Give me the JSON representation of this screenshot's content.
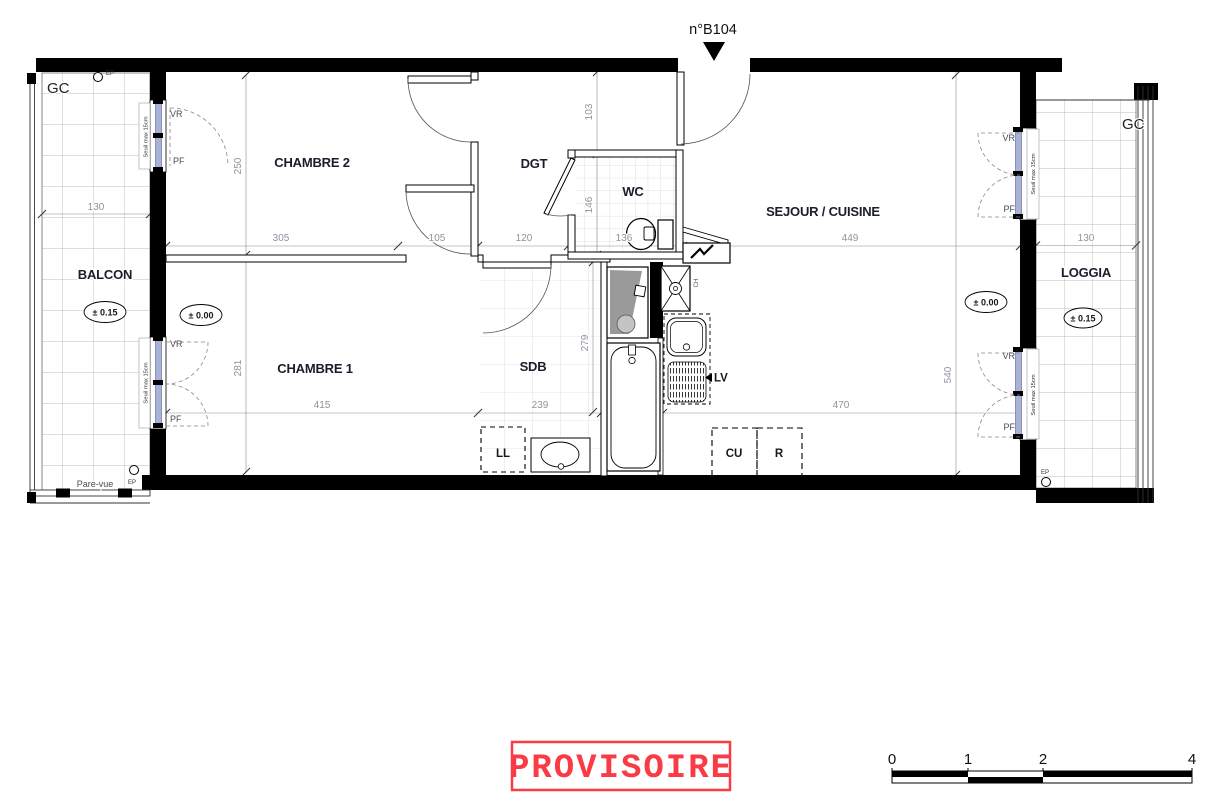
{
  "title": {
    "unit": "n°B104"
  },
  "rooms": {
    "chambre2": "CHAMBRE 2",
    "chambre1": "CHAMBRE 1",
    "dgt": "DGT",
    "wc": "WC",
    "sejour": "SEJOUR / CUISINE",
    "sdb": "SDB",
    "balcon": "BALCON",
    "loggia": "LOGGIA"
  },
  "levels": {
    "exterior": "± 0.15",
    "interior": "± 0.00"
  },
  "annotations": {
    "gc": "GC",
    "ep": "EP",
    "vr": "VR",
    "pf": "PF",
    "seuil": "Seuil max 15cm",
    "pare_vue": "Pare-vue",
    "ch": "CH"
  },
  "equipment": {
    "ll": "LL",
    "lv": "LV",
    "cu": "CU",
    "r": "R"
  },
  "dims": {
    "d130": "130",
    "d250": "250",
    "d305": "305",
    "d105": "105",
    "d120": "120",
    "d136": "136",
    "d103": "103",
    "d146": "146",
    "d449": "449",
    "d540": "540",
    "d281": "281",
    "d415": "415",
    "d239": "239",
    "d279": "279",
    "d470": "470"
  },
  "stamp": {
    "text": "PROVISOIRE",
    "color": "#fa3a44"
  },
  "scale_bar": {
    "labels": [
      "0",
      "1",
      "2",
      "4"
    ]
  }
}
